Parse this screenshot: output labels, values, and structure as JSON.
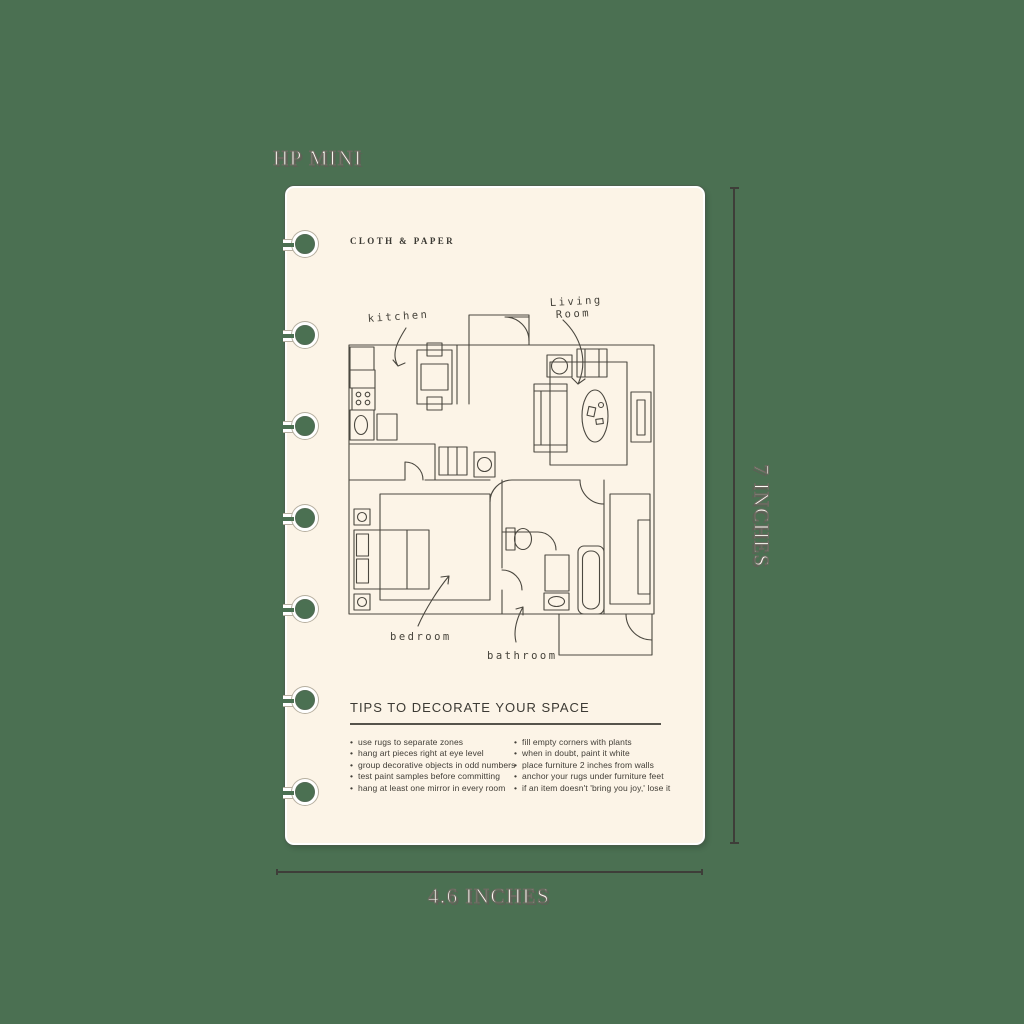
{
  "canvas": {
    "background_color": "#4b7052"
  },
  "dimensions": {
    "size_name": "HP MINI",
    "height_label": "7 INCHES",
    "width_label": "4.6 INCHES"
  },
  "page": {
    "brand": "CLOTH & PAPER",
    "paper_color": "#fcf4e7",
    "binding_holes": 7
  },
  "floor_plan": {
    "labels": {
      "kitchen": "kitchen",
      "living_line1": "Living",
      "living_line2": "Room",
      "bedroom": "bedroom",
      "bathroom": "bathroom"
    }
  },
  "tips": {
    "heading": "TIPS TO DECORATE YOUR SPACE",
    "left": [
      "use rugs to separate zones",
      "hang art pieces right at eye level",
      "group decorative objects in odd numbers",
      "test paint samples before committing",
      "hang at least one mirror in every room"
    ],
    "right": [
      "fill empty corners with plants",
      "when in doubt, paint it white",
      "place furniture 2 inches from walls",
      "anchor your rugs under furniture feet",
      "if an item doesn't 'bring you joy,' lose it"
    ]
  }
}
